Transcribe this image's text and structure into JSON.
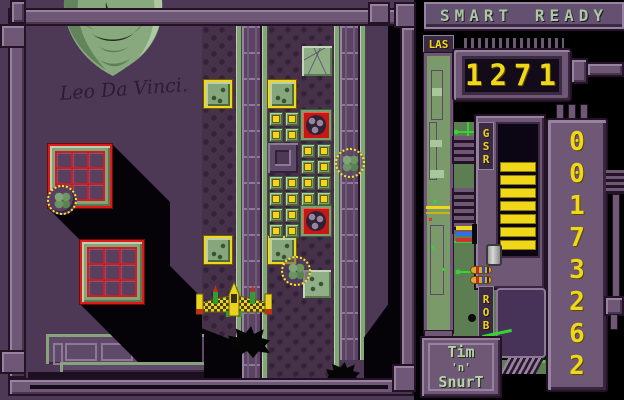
{
  "window": {
    "width": 624,
    "height": 400
  },
  "colors": {
    "background": "#000000",
    "field_purple": "#4d3955",
    "machine_purple": "#6e5876",
    "pipe_green": "#86a47b",
    "board_green": "#5d7d53",
    "trace_green": "#33d433",
    "accent_yellow": "#f0d818",
    "accent_red": "#cc1616",
    "hud_text_green": "#a9c9a1"
  },
  "hud": {
    "status_left": "SMART",
    "status_right": "READY",
    "laser_label": "LAS",
    "score": "1271",
    "gauge_label": "GSR",
    "gauge_bar_count": 7,
    "rob_label": "ROB",
    "code_digits": [
      "0",
      "0",
      "1",
      "7",
      "3",
      "2",
      "6",
      "2"
    ],
    "logo_line1": "Tim",
    "logo_line2": "'n'",
    "logo_line3": "SnurT"
  },
  "playfield": {
    "signature": "Leo Da Vinci.",
    "ship": {
      "x": 196,
      "y": 282
    },
    "sprites": {
      "red_block": [
        [
          48,
          144
        ],
        [
          80,
          240
        ]
      ],
      "ball": [
        [
          47,
          185
        ]
      ],
      "yellow_border_tile": [
        [
          204,
          80
        ],
        [
          268,
          80
        ],
        [
          204,
          236
        ],
        [
          268,
          236
        ]
      ],
      "small_tile": [
        [
          269,
          112
        ],
        [
          285,
          112
        ],
        [
          269,
          128
        ],
        [
          285,
          128
        ],
        [
          301,
          144
        ],
        [
          317,
          144
        ],
        [
          301,
          160
        ],
        [
          317,
          160
        ],
        [
          269,
          176
        ],
        [
          285,
          176
        ],
        [
          301,
          176
        ],
        [
          317,
          176
        ],
        [
          269,
          192
        ],
        [
          285,
          192
        ],
        [
          301,
          192
        ],
        [
          317,
          192
        ],
        [
          269,
          208
        ],
        [
          285,
          208
        ],
        [
          269,
          224
        ],
        [
          285,
          224
        ]
      ],
      "red_ball_tile": [
        [
          301,
          110
        ],
        [
          301,
          206
        ]
      ],
      "purple_tile": [
        [
          268,
          143
        ]
      ],
      "cracked_tile": [
        [
          302,
          46
        ]
      ],
      "green_tile": [
        [
          303,
          270
        ]
      ],
      "cursor": [
        [
          335,
          148
        ],
        [
          281,
          256
        ]
      ],
      "blast": [
        [
          228,
          326,
          42,
          32
        ],
        [
          326,
          362,
          34,
          24
        ]
      ]
    }
  }
}
